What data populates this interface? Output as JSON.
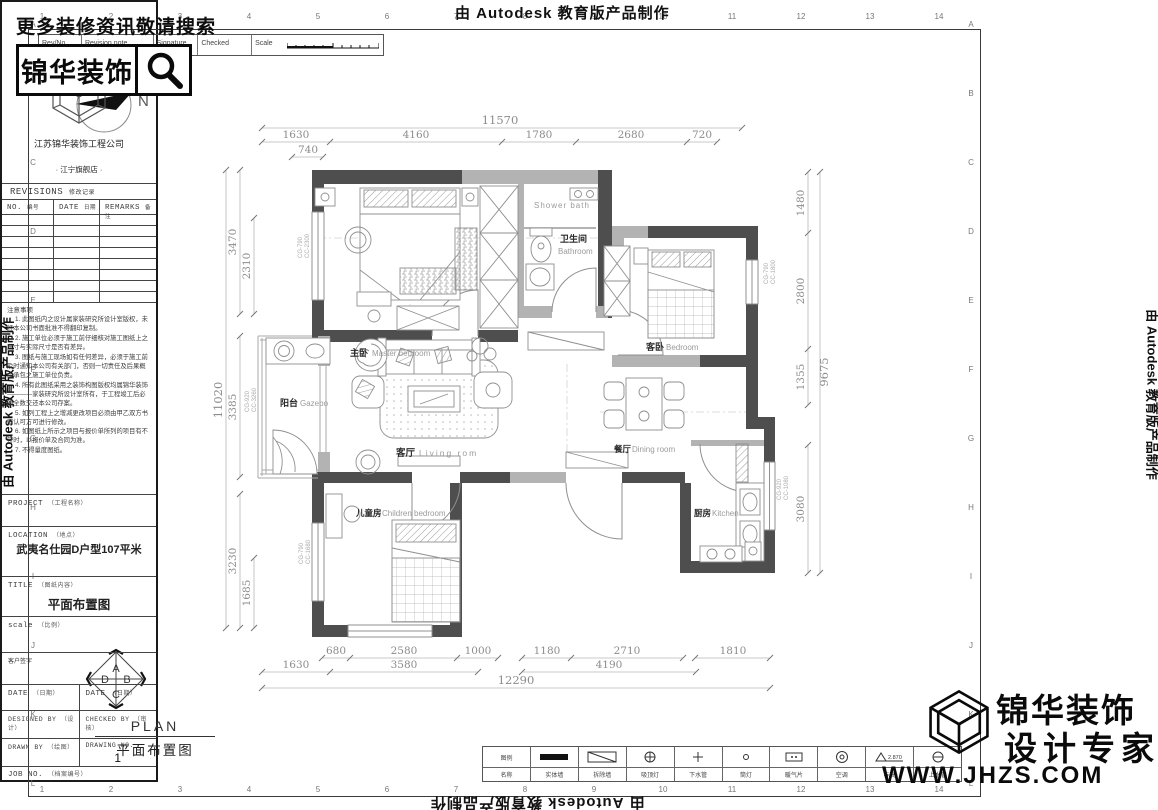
{
  "watermarks": {
    "autodesk": "由 Autodesk 教育版产品制作"
  },
  "promo": {
    "text": "更多装修资讯敬请搜索",
    "brand": "锦华装饰"
  },
  "strip": {
    "rev_no": "Rev/No",
    "revision_note": "Revision note",
    "signature": "Signature",
    "checked": "Checked",
    "scale": "Scale"
  },
  "compass": {
    "label": "N"
  },
  "grid": {
    "cols": [
      "1",
      "2",
      "3",
      "4",
      "5",
      "6",
      "7",
      "8",
      "9",
      "10",
      "11",
      "12",
      "13",
      "14"
    ],
    "rows": [
      "A",
      "B",
      "C",
      "D",
      "E",
      "F",
      "G",
      "H",
      "I",
      "J",
      "K",
      "L"
    ]
  },
  "rooms": {
    "master": {
      "cn": "主卧",
      "en": "Master bedroom"
    },
    "shower": {
      "en": "Shower bath"
    },
    "bathroom": {
      "cn": "卫生间",
      "en": "Bathroom"
    },
    "bedroom": {
      "cn": "客卧",
      "en": "Bedroom"
    },
    "balcony": {
      "cn": "阳台",
      "en": "Gazebo"
    },
    "living": {
      "cn": "客厅",
      "en": "Living rom"
    },
    "dining": {
      "cn": "餐厅",
      "en": "Dining room"
    },
    "children": {
      "cn": "儿童房",
      "en": "Children bedroom"
    },
    "kitchen": {
      "cn": "厨房",
      "en": "Kitchen"
    }
  },
  "dims": {
    "top": {
      "total": "11570",
      "segments": [
        "1630",
        "4160",
        "1780",
        "2680",
        "720"
      ],
      "sub": "740"
    },
    "left": {
      "total": "11020",
      "segments": [
        "3470",
        "2310",
        "3385",
        "3230",
        "1685"
      ]
    },
    "right": {
      "total": "9675",
      "segments": [
        "1480",
        "2800",
        "1355",
        "3080"
      ]
    },
    "bottom": {
      "row1": [
        "680",
        "2580",
        "1000",
        "1180",
        "2710",
        "1810"
      ],
      "row2": [
        "1630",
        "3580",
        "4190"
      ],
      "total": "12290"
    }
  },
  "window_codes": [
    [
      "CG-790",
      "CC-2300"
    ],
    [
      "CG-920",
      "CC-3260"
    ],
    [
      "CG-790",
      "CC-1800"
    ],
    [
      "CG-920",
      "CC-1080"
    ],
    [
      "CG-790",
      "CC-1680"
    ]
  ],
  "plan_title": {
    "en": "PLAN",
    "cn": "平面布置图"
  },
  "direction": {
    "top": "A",
    "right": "B",
    "bottom": "C",
    "left": "D"
  },
  "legend": {
    "cells": [
      {
        "top": "图例",
        "label": "名称"
      },
      {
        "label": "实体墙"
      },
      {
        "label": "拆除墙"
      },
      {
        "label": "吸顶灯"
      },
      {
        "label": "下水管"
      },
      {
        "label": "筒灯"
      },
      {
        "label": "暖气片"
      },
      {
        "label": "空调"
      },
      {
        "label": "标高",
        "value": "2.870"
      },
      {
        "label": "上水管"
      }
    ]
  },
  "title_block": {
    "company": "江苏锦华装饰工程公司",
    "store": "· 江宁旗舰店 ·",
    "revisions": {
      "title": "REVISIONS",
      "title_cn": "修改记录",
      "col1_en": "NO.",
      "col1_cn": "编号",
      "col2_en": "DATE",
      "col2_cn": "日期",
      "col3_en": "REMARKS",
      "col3_cn": "备注"
    },
    "notes_title": "注意事项",
    "notes": [
      "1. 此图纸内之设计属家装研究所设计室版权，未经本公司书面批准不得翻印复制。",
      "2. 施工单位必须于施工前仔细核对施工图纸上之尺寸与实际尺寸是否有差异。",
      "3. 图纸与施工现场如有任何差异，必须于施工前及时通知本公司有关部门，否则一切责任及后果概由承包之施工单位负责。",
      "4. 所有此图纸采用之装饰构图版权均属锦华装饰————家装研究所设计室所有，于工程竣工后必须全数交还本公司存案。",
      "5. 如列工程上之增减更改项目必须由甲乙双方书面认可方可进行修改。",
      "6. 如图纸上所示之项目与报价单所列的项目有不符时，以报价单及合同为准。",
      "7. 不得量度图纸。"
    ],
    "fields": {
      "project": {
        "en": "PROJECT",
        "cn": "（工程名称）"
      },
      "location": {
        "en": "LOCATION",
        "cn": "（地点）",
        "value": "武夷名仕园D户型107平米"
      },
      "title": {
        "en": "TITLE",
        "cn": "（图纸内容）",
        "value": "平面布置图"
      },
      "scale": {
        "en": "scale",
        "cn": "（比例）"
      },
      "client": "客户签字",
      "date1": {
        "en": "DATE",
        "cn": "（日期）"
      },
      "date2": {
        "en": "DATE",
        "cn": "（日期）"
      },
      "designed": {
        "en": "DESIGNED BY",
        "cn": "（设计）"
      },
      "checked": {
        "en": "CHECKED BY",
        "cn": "（审核）"
      },
      "drawn": {
        "en": "DRAWN BY",
        "cn": "（绘图）"
      },
      "drawing_no": {
        "en": "DRAWING NO.",
        "value": "1"
      },
      "job_no": {
        "en": "JOB NO.",
        "cn": "（档案编号）"
      }
    },
    "brand_overlay": {
      "line1": "锦华装饰",
      "line2": "设计专家",
      "url": "WWW.JHZS.COM"
    }
  },
  "colors": {
    "wall_dark": "#4e4e4e",
    "wall_gray": "#b3b3b3",
    "furniture_line": "#8f8f8f",
    "dim_text": "#8c8c8c"
  }
}
